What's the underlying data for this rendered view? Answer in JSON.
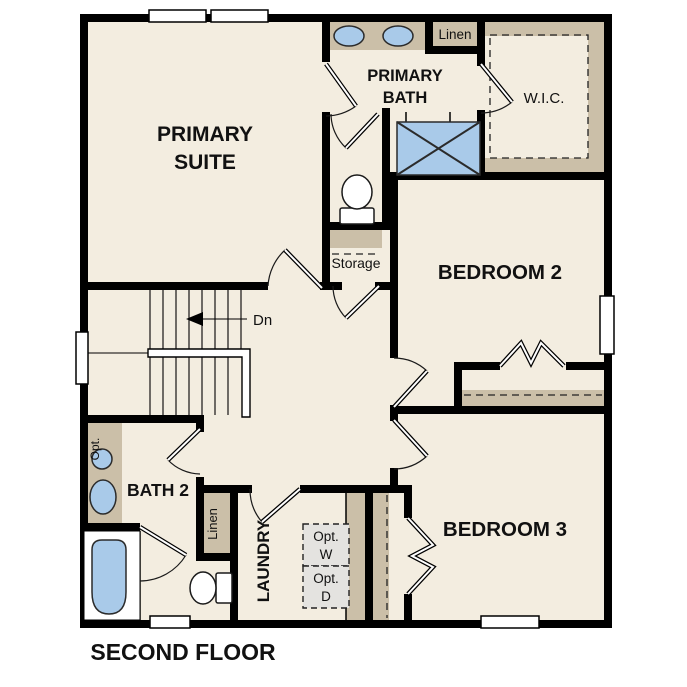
{
  "plan_title": "SECOND FLOOR",
  "colors": {
    "wall": "#000000",
    "floor": "#f3ede0",
    "casework": "#cbbfa8",
    "fixture": "#a9cae9",
    "appliance": "#e4e3e0"
  },
  "rooms": {
    "primary_suite": {
      "line1": "PRIMARY",
      "line2": "SUITE"
    },
    "primary_bath": {
      "line1": "PRIMARY",
      "line2": "BATH"
    },
    "wic": {
      "label": "W.I.C."
    },
    "bedroom2": {
      "label": "BEDROOM 2"
    },
    "bedroom3": {
      "label": "BEDROOM 3"
    },
    "bath2": {
      "label": "BATH 2"
    },
    "laundry": {
      "label": "LAUNDRY"
    },
    "storage": {
      "label": "Storage"
    },
    "linen_upper": {
      "label": "Linen"
    },
    "linen_lower": {
      "label": "Linen"
    }
  },
  "annotations": {
    "stair_direction": "Dn",
    "optional_washer": {
      "line1": "Opt.",
      "line2": "W"
    },
    "optional_dryer": {
      "line1": "Opt.",
      "line2": "D"
    },
    "optional_sink": "Opt."
  },
  "fixtures": {
    "primary_bath_sinks": "double-vanity-sinks",
    "primary_bath_shower": "shower",
    "primary_bath_toilet": "toilet",
    "bath2_sink": "vanity-sink",
    "bath2_optional_sink": "optional-sink",
    "bath2_tub": "bathtub",
    "bath2_toilet": "toilet",
    "stairs": "staircase-down"
  }
}
